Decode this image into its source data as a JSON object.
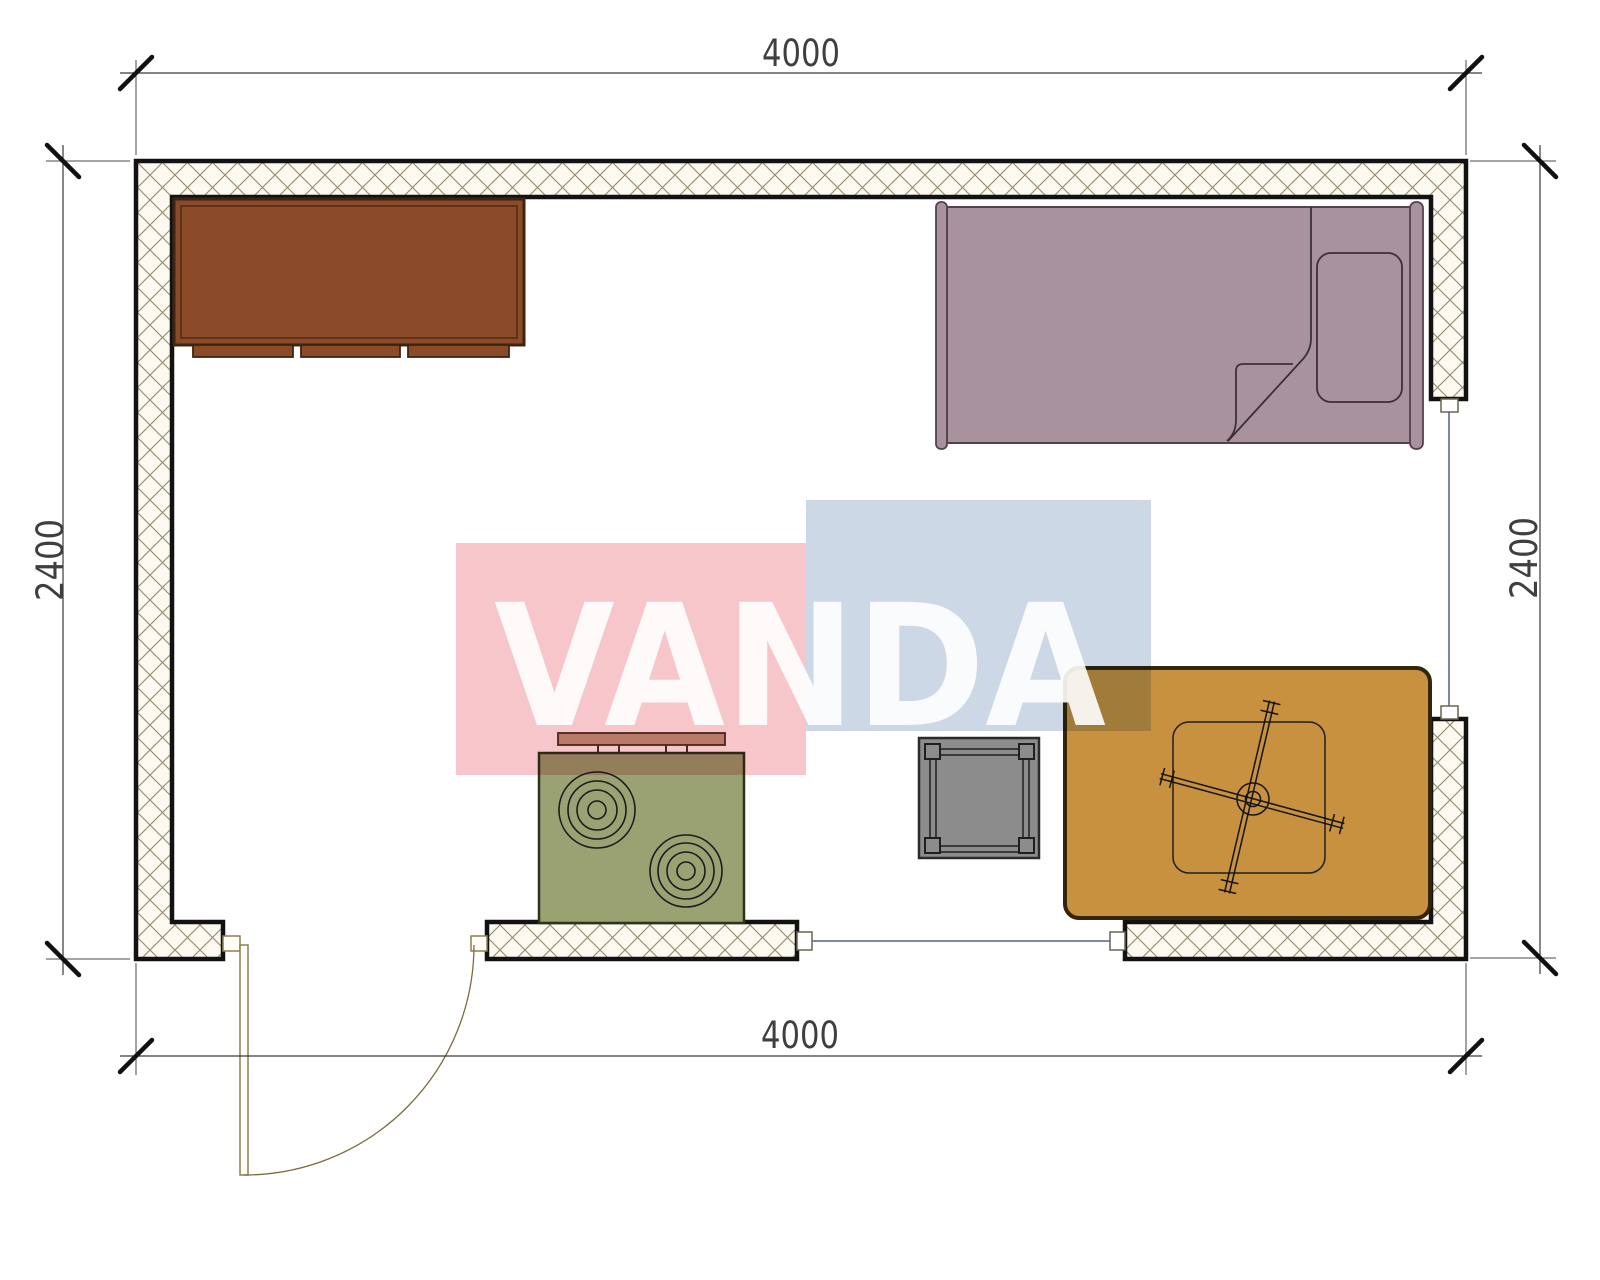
{
  "drawing": {
    "kind": "room-floor-plan",
    "watermark": {
      "text": "VANDA",
      "pink_block": "#f6c6cb",
      "blue_block": "#cdd8e7",
      "letter_color": "#ffffff"
    },
    "dimensions": {
      "top": "4000",
      "bottom": "4000",
      "left": "2400",
      "right": "2400"
    },
    "colors": {
      "wall_outline": "#121212",
      "wall_hatch_bg": "#fcf9f0",
      "wall_hatch_line": "#92896a",
      "cabinet": "#8b4a28",
      "cabinet_outline": "#3f2412",
      "bed": "#a8929d",
      "bed_outline": "#55414d",
      "stove": "#9aa172",
      "stove_hood": "#c09d84",
      "gray_table": "#8c8c8c",
      "kotatsu_table": "#c8913f",
      "door": "#8f7e52",
      "window_line": "#7d88a8",
      "dim_color": "#3f3f3f"
    },
    "furniture": {
      "items": [
        "cabinet",
        "bed",
        "stove",
        "side-table",
        "kotatsu-table-with-fan"
      ]
    }
  }
}
